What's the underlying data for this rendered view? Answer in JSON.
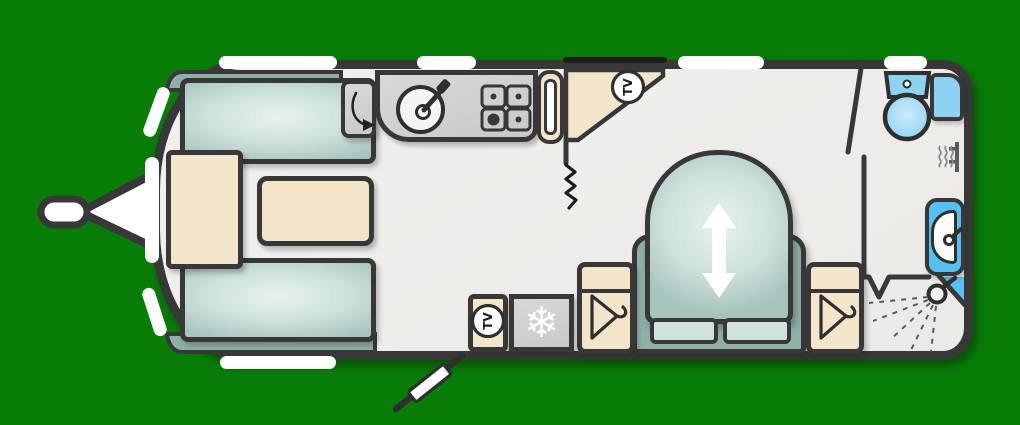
{
  "title": "Caravan floor plan (overhead layout diagram)",
  "labels": {
    "tv": "TV"
  },
  "glyphs": {
    "freezer": "❄"
  },
  "colors": {
    "bg": "#087d08",
    "line": "#383838",
    "accentDark": "#1d1d1d",
    "floor": "#f1f0ee",
    "tealDark": "#8fafa9",
    "tealEdge": "#a6c3be",
    "tealMid": "#cfe2de",
    "tealLight": "#e6f1ef",
    "beige": "#f3e5c9",
    "gray": "#c9c9c9",
    "grayLight": "#d8d8d8",
    "blue": "#8ed2f2",
    "blueLight": "#c9eafb",
    "blueBright": "#55c1f3",
    "white": "#ffffff"
  },
  "features": [
    "tow-hitch",
    "front-lounge-sofa-pair",
    "front-chest",
    "coffee-table",
    "worktop-flap",
    "kitchen-sink",
    "gas-hob",
    "tall-cupboard",
    "front-tv-cabinet",
    "curtain-divider",
    "entrance-door",
    "tv-locker",
    "fridge-freezer",
    "wardrobe",
    "bedroom-wardrobe",
    "island-bed-with-slide-arrow",
    "bathroom-door",
    "toilet",
    "bathroom-cabinet",
    "wall-heater",
    "washbasin",
    "corner-shower"
  ]
}
